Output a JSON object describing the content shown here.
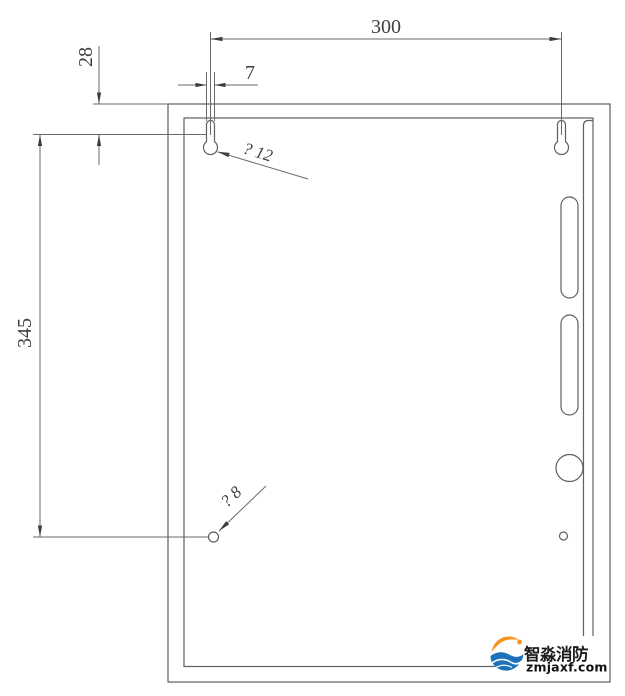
{
  "drawing": {
    "type": "installation-dimension-drawing",
    "dimensions": {
      "top_width": "300",
      "keyhole_slot_width": "7",
      "keyhole_top_offset": "28",
      "mount_hole_vertical_spacing": "345",
      "keyhole_diameter_label": "? 12",
      "bottom_hole_diameter_label": "? 8"
    },
    "colors": {
      "line": "#5f5f5f",
      "dimension_text": "#3f3f3f",
      "background": "#ffffff"
    }
  },
  "watermark": {
    "brand": "智淼消防",
    "website": "zmjaxf.com",
    "colors": {
      "orange": "#f6921e",
      "blue": "#1b72b8",
      "text": "#1d1d1d"
    }
  }
}
